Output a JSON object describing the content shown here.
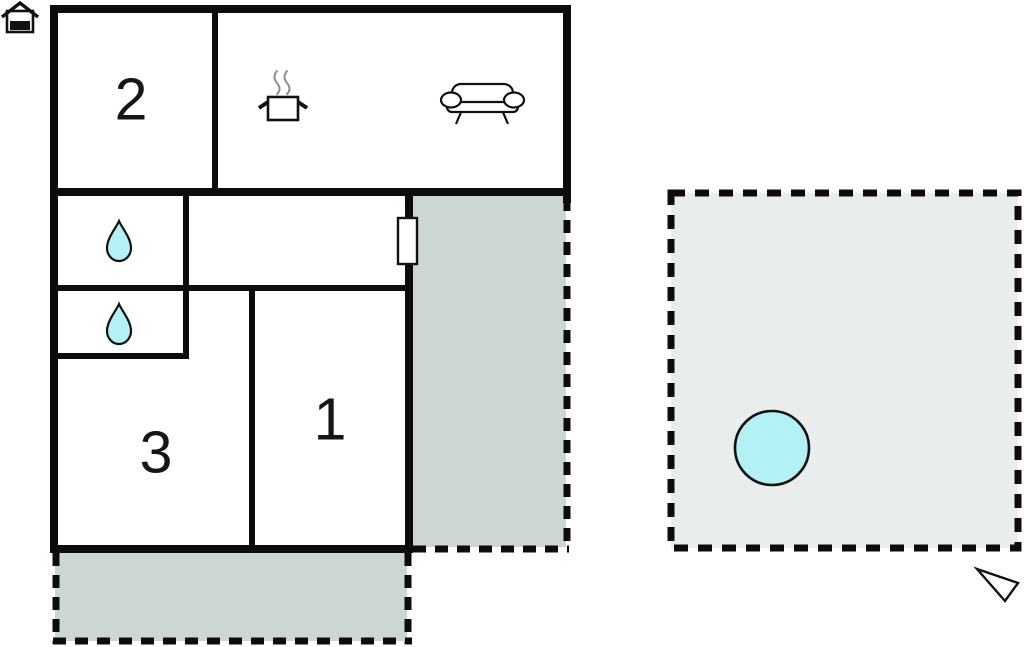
{
  "colors": {
    "wall": "#0c0c0c",
    "water_fill": "#b3f1f7",
    "terrace_fill": "#ccd6d5",
    "plot_fill": "#e9eeed",
    "steam": "#8f8f8f",
    "page_background": "#ffffff"
  },
  "floor_plan": {
    "rooms": {
      "room1": {
        "label": "1"
      },
      "room2": {
        "label": "2"
      },
      "room3": {
        "label": "3"
      }
    },
    "icons": [
      "house-icon",
      "cooking-pot-icon",
      "sofa-icon",
      "water-drop-icon",
      "water-drop-icon",
      "door-marker",
      "pool-circle",
      "north-arrow-icon"
    ]
  }
}
